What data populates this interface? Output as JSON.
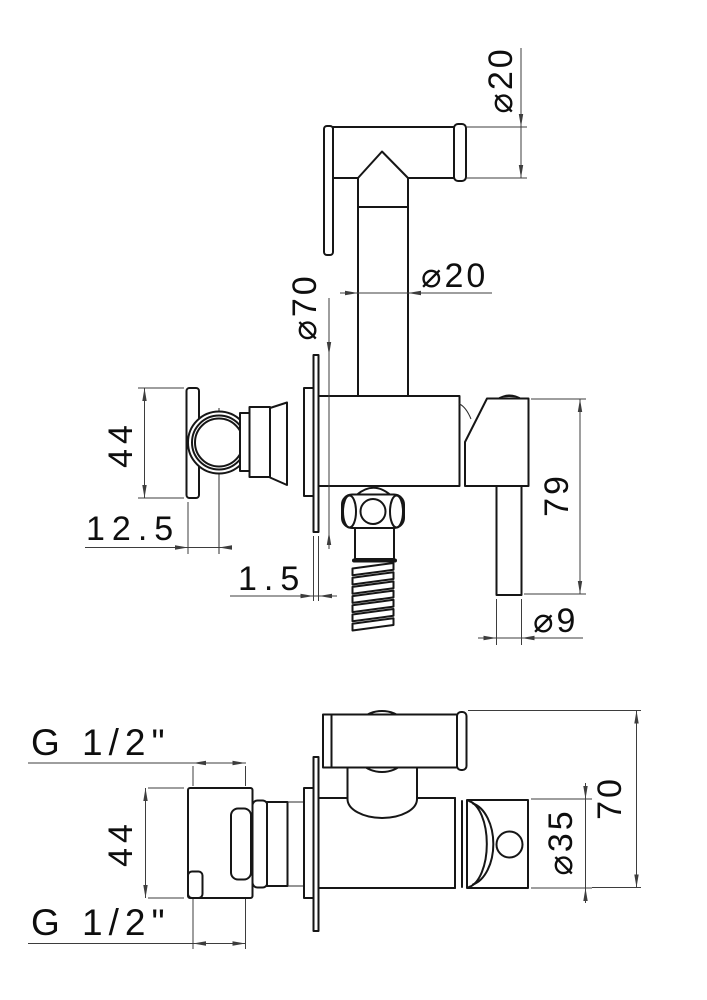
{
  "front_view": {
    "spray_head_diameter": "⌀20",
    "tube_diameter": "⌀20",
    "flange_diameter": "⌀70",
    "bracket_height": "44",
    "axis_offset": "12.5",
    "plate_thickness": "1.5",
    "lever_length": "79",
    "rod_diameter": "⌀9"
  },
  "plan_view": {
    "inlet_thread": "G 1/2\"",
    "outlet_thread": "G 1/2\"",
    "bracket_depth": "44",
    "body_diameter": "⌀35",
    "overall_depth": "70"
  }
}
